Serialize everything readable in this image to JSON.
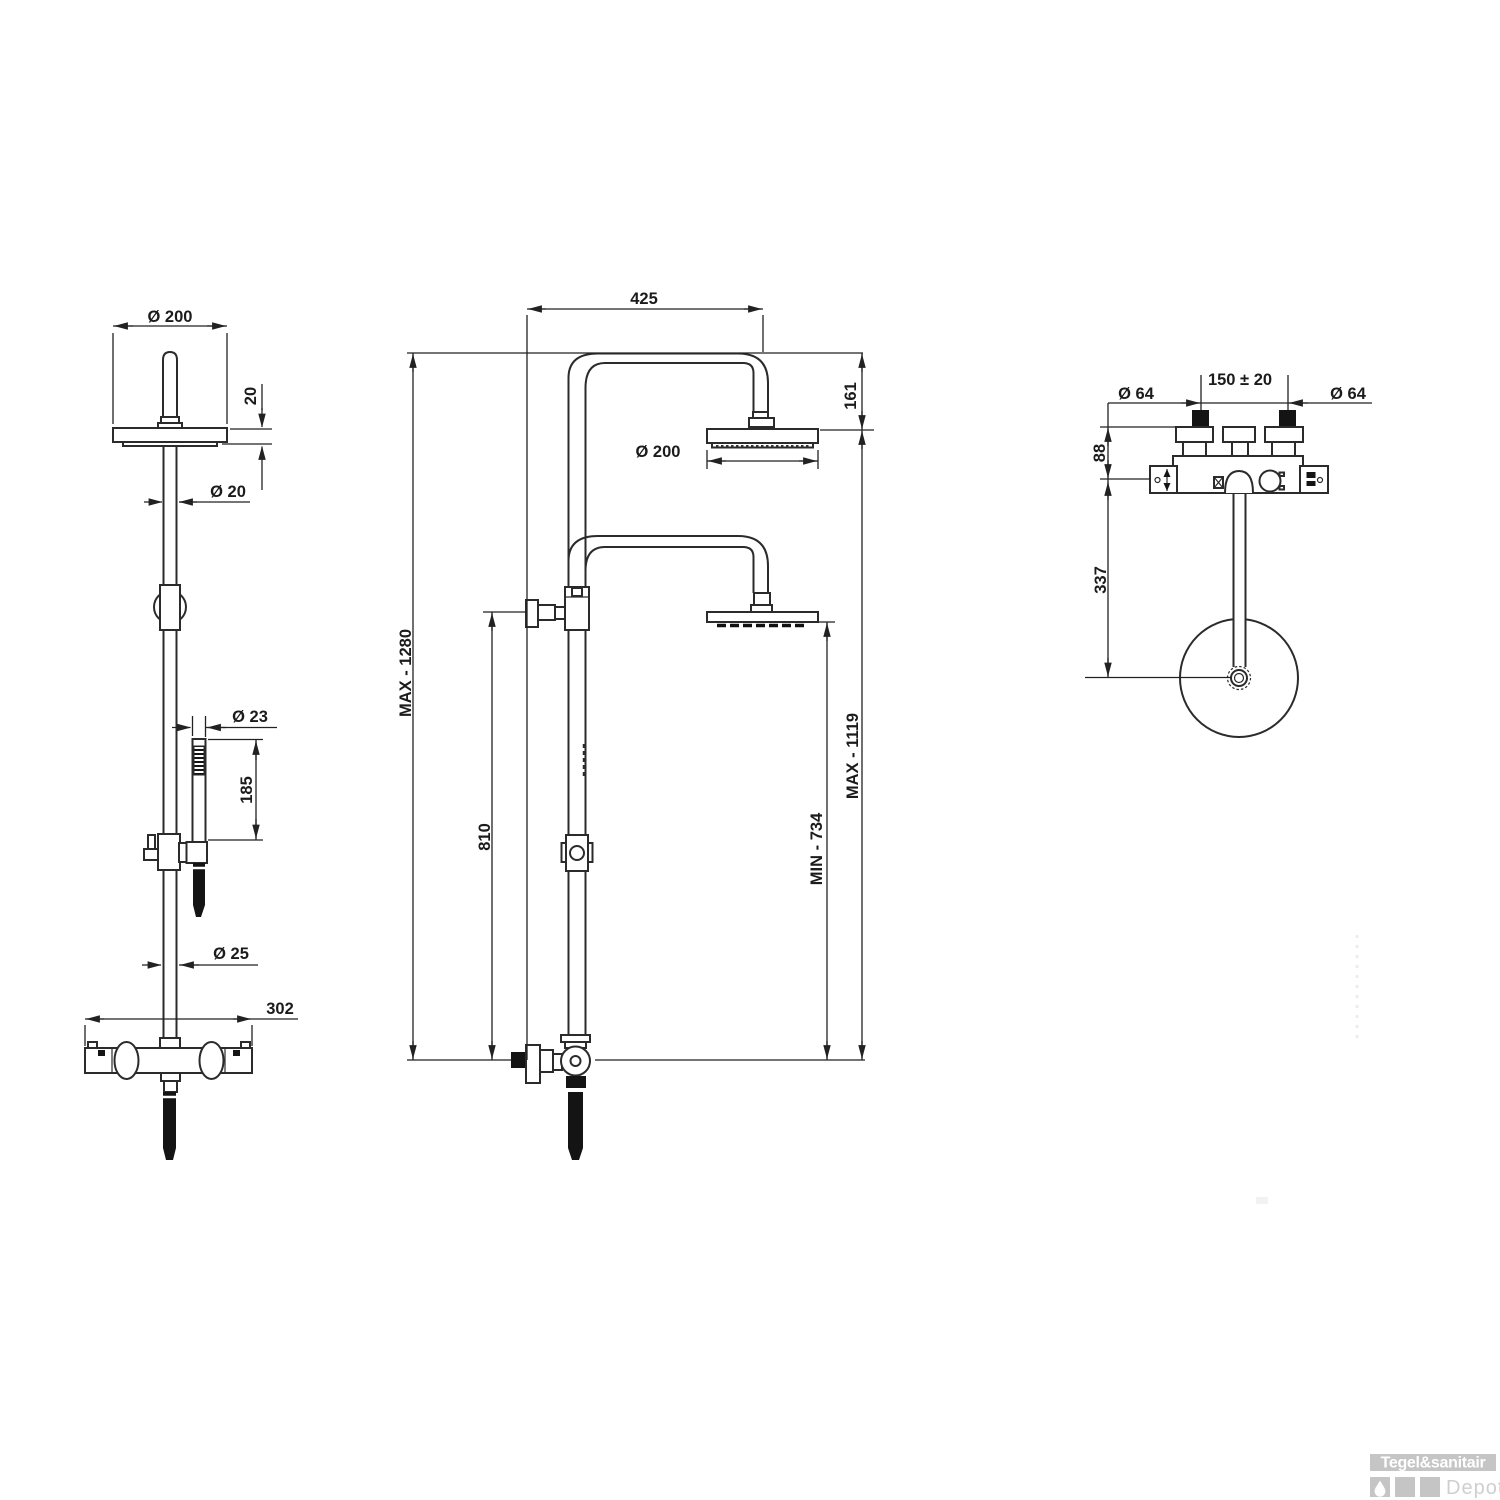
{
  "drawing": {
    "side_view": {
      "head_diameter": "Ø  200",
      "head_thickness": "20",
      "pipe_diameter": "Ø  20",
      "handset_diameter": "Ø  23",
      "handset_length": "185",
      "riser_diameter": "Ø  25",
      "mixer_width": "302"
    },
    "front_view": {
      "arm_reach": "425",
      "head_drop": "161",
      "head_diameter": "Ø  200",
      "max_total_height": "MAX -  1280",
      "bracket_height": "810",
      "min_handset_height": "MIN - 734",
      "max_head_height": "MAX -  1119"
    },
    "top_view": {
      "left_handle_diameter": "Ø  64",
      "handle_spacing": "150 ± 20",
      "right_handle_diameter": "Ø  64",
      "mixer_offset": "88",
      "head_center_offset": "337"
    }
  },
  "logo": {
    "brand": "Tegel&sanitair",
    "sub_brand": "Depot"
  }
}
